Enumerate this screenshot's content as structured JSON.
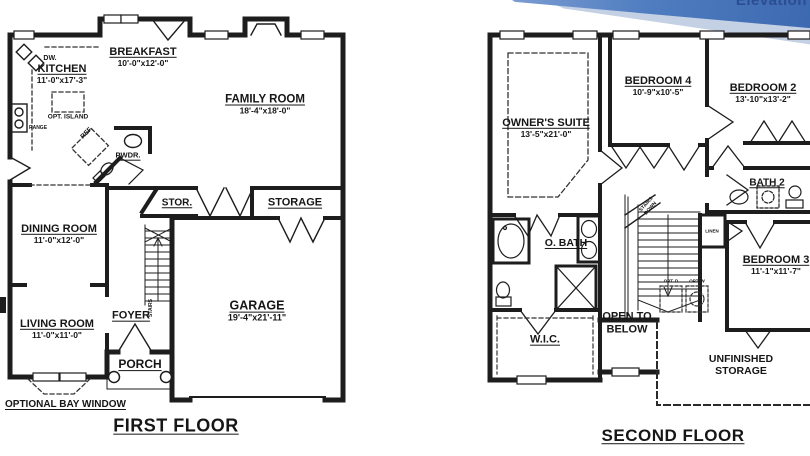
{
  "banner": {
    "watermark": "Elevation",
    "band_color": "#4f7dc0",
    "shadow_color": "#c4d0e4"
  },
  "line_color": "#1d1d1d",
  "first_floor": {
    "title": "FIRST FLOOR",
    "rooms": {
      "breakfast": {
        "name": "BREAKFAST",
        "dims": "10'-0\"x12'-0\""
      },
      "kitchen": {
        "name": "KITCHEN",
        "dims": "11'-0\"x17'-3\""
      },
      "family_room": {
        "name": "FAMILY ROOM",
        "dims": "18'-4\"x18'-0\""
      },
      "dining_room": {
        "name": "DINING ROOM",
        "dims": "11'-0\"x12'-0\""
      },
      "living_room": {
        "name": "LIVING ROOM",
        "dims": "11'-0\"x11'-0\""
      },
      "garage": {
        "name": "GARAGE",
        "dims": "19'-4\"x21'-11\""
      },
      "powder": {
        "name": "PWDR."
      },
      "stor": {
        "name": "STOR."
      },
      "storage": {
        "name": "STORAGE"
      },
      "foyer": {
        "name": "FOYER"
      },
      "porch": {
        "name": "PORCH"
      }
    },
    "annotations": {
      "dw": "DW.",
      "opt_island": "OPT. ISLAND",
      "range": "RANGE",
      "ref": "REF.",
      "stairs": "STAIRS",
      "optional_bay_window": "OPTIONAL BAY WINDOW"
    }
  },
  "second_floor": {
    "title": "SECOND FLOOR",
    "rooms": {
      "owners_suite": {
        "name": "OWNER'S SUITE",
        "dims": "13'-5\"x21'-0\""
      },
      "bedroom_4": {
        "name": "BEDROOM 4",
        "dims": "10'-9\"x10'-5\""
      },
      "bedroom_2": {
        "name": "BEDROOM 2",
        "dims": "13'-10\"x13'-2\""
      },
      "bedroom_3": {
        "name": "BEDROOM 3",
        "dims": "11'-1\"x11'-7\""
      },
      "bath_2": {
        "name": "BATH 2"
      },
      "owners_bath": {
        "name": "O. BATH"
      },
      "wic": {
        "name": "W.I.C."
      }
    },
    "annotations": {
      "linen": "LINEN",
      "stairs_down": "STAIRS\nDOWN",
      "opt_d": "OPT. D",
      "opt_w": "OPT. W",
      "open_to_below": "OPEN TO\nBELOW",
      "unfinished_storage": "UNFINISHED\nSTORAGE"
    }
  }
}
